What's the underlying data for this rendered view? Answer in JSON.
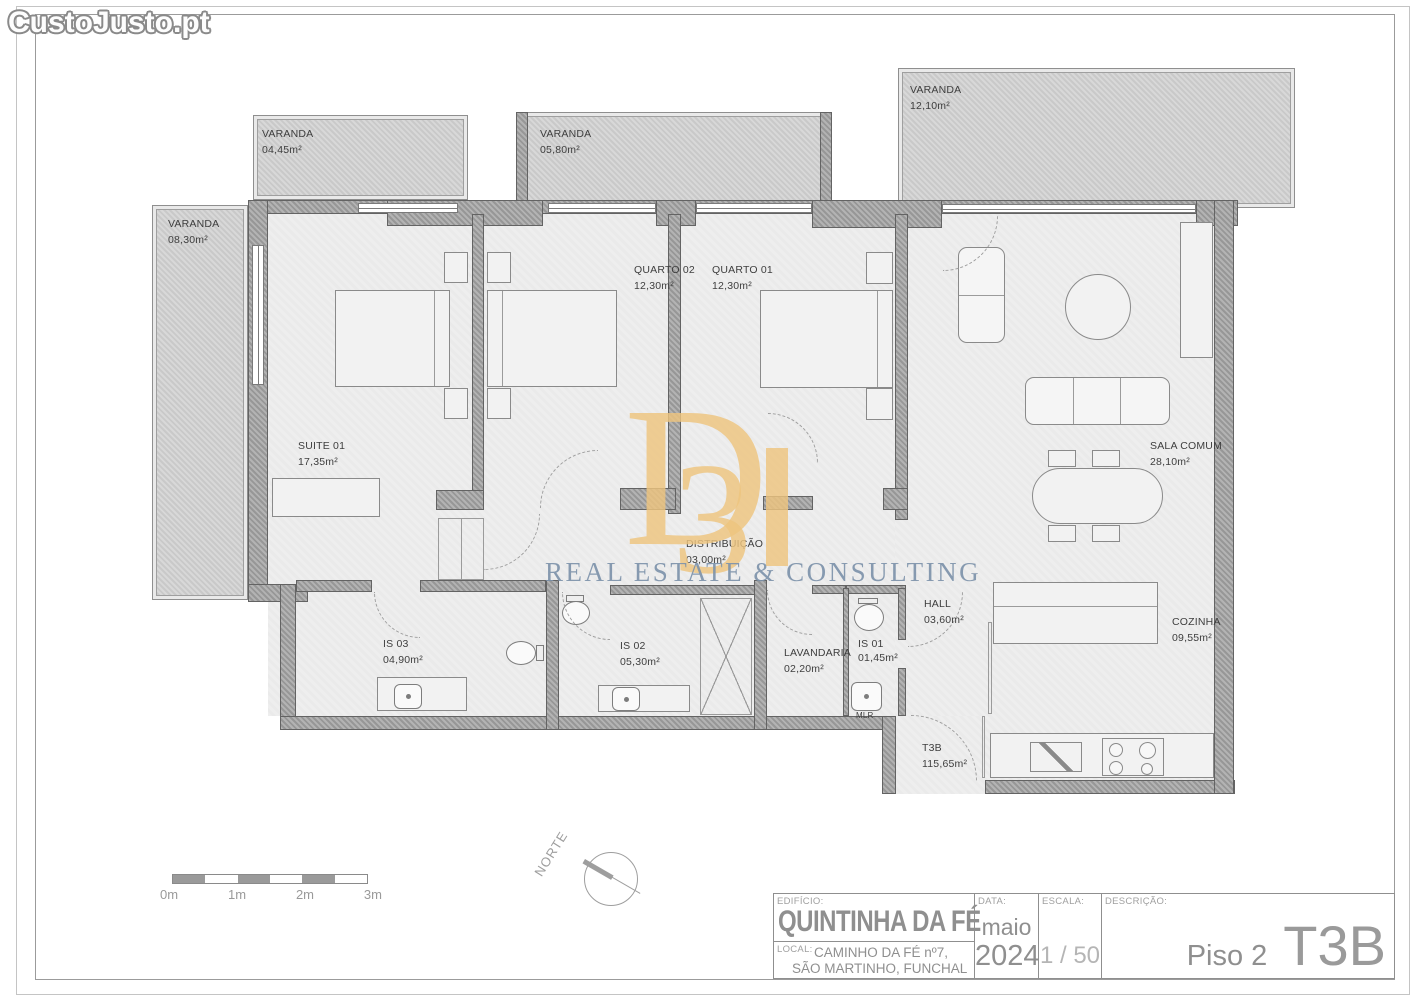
{
  "site_watermark": "CustoJusto.pt",
  "brand": {
    "letter_d": "D",
    "letter_3": "3",
    "subtitle": "REAL ESTATE & CONSULTING"
  },
  "rooms": [
    {
      "name": "VARANDA",
      "area": "04,45m²"
    },
    {
      "name": "VARANDA",
      "area": "05,80m²"
    },
    {
      "name": "VARANDA",
      "area": "12,10m²"
    },
    {
      "name": "VARANDA",
      "area": "08,30m²"
    },
    {
      "name": "SUITE 01",
      "area": "17,35m²"
    },
    {
      "name": "QUARTO 02",
      "area": "12,30m²"
    },
    {
      "name": "QUARTO 01",
      "area": "12,30m²"
    },
    {
      "name": "SALA COMUM",
      "area": "28,10m²"
    },
    {
      "name": "DISTRIBUIÇÃO",
      "area": "03,00m²"
    },
    {
      "name": "HALL",
      "area": "03,60m²"
    },
    {
      "name": "IS 03",
      "area": "04,90m²"
    },
    {
      "name": "IS 02",
      "area": "05,30m²"
    },
    {
      "name": "LAVANDARIA",
      "area": "02,20m²"
    },
    {
      "name": "IS 01",
      "area": "01,45m²"
    },
    {
      "name": "COZINHA",
      "area": "09,55m²"
    },
    {
      "name": "T3B",
      "area": "115,65m²"
    }
  ],
  "annotations": {
    "mlr": "MLR"
  },
  "scale_bar": {
    "labels": [
      "0m",
      "1m",
      "2m",
      "3m"
    ]
  },
  "compass": {
    "label": "NORTE"
  },
  "title_block": {
    "edificio_label": "EDIFÍCIO:",
    "edificio": "QUINTINHA DA FÉ",
    "local_label": "LOCAL:",
    "local_line1": "CAMINHO DA FÉ nº7,",
    "local_line2": "SÃO MARTINHO, FUNCHAL",
    "data_label": "DATA:",
    "month": "maio",
    "year": "2024",
    "escala_label": "ESCALA:",
    "escala_value": "1 / 50",
    "descricao_label": "DESCRIÇÃO:",
    "floor": "Piso 2",
    "typology": "T3B"
  },
  "colors": {
    "logo_gold": "#eec57f",
    "logo_blue": "#7e93ab",
    "wall_gray": "#a3a3a3",
    "floor_gray": "#ededed"
  }
}
